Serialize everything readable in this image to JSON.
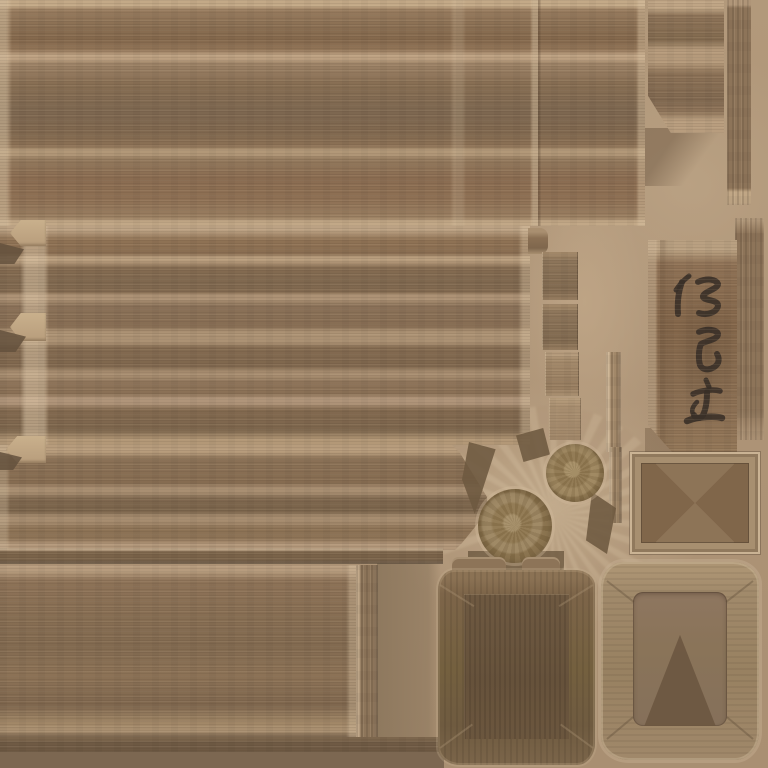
{
  "meta": {
    "title": "wooden-texture-atlas",
    "description": "Game texture atlas of weathered wooden planks, a vertical Japanese shop sign, round log-end discs, a square tub panel and two wooden frames on a tan background",
    "canvas_width": 768,
    "canvas_height": 768
  },
  "palette": {
    "background": "#b2997b",
    "background_dark": "#8a745a",
    "plank": "#8b7257",
    "plank_dark": "#7f684f",
    "seam_light": "#c2aa8b",
    "edge_shadow": "#5f4d3b",
    "sign_board": "#83664a",
    "ink": "#3a3028",
    "panel": "#74603f",
    "frame_wood": "#a18a6b",
    "knob_wood": "#9c8662",
    "wedge": "#6d5940"
  },
  "sign": {
    "text": "仁己堂",
    "characters": [
      "仁",
      "己",
      "堂"
    ],
    "orientation": "vertical",
    "style": "brush calligraphy, carved dark ink on wood board",
    "ink_color": "#3a3028",
    "glyphs": [
      {
        "name": "char-1",
        "strokes": [
          {
            "d": "M21,10 C17,13 12,18 8,24",
            "w": 5
          },
          {
            "d": "M14,16 C11,24 9,34 10,48",
            "w": 6
          },
          {
            "d": "M30,16 C39,12 48,13 50,18 C50,23 37,25 35,30 C34,35 49,33 50,39 C50,46 39,50 31,47",
            "w": 6
          }
        ]
      },
      {
        "name": "char-2",
        "strokes": [
          {
            "d": "M31,66 C40,62 49,64 50,68 C50,74 37,75 33,78 C31,82 30,92 32,99 C35,106 46,104 50,97 C51,94 51,91 49,88",
            "w": 6
          }
        ]
      },
      {
        "name": "char-3",
        "strokes": [
          {
            "d": "M38,114 L41,121",
            "w": 5
          },
          {
            "d": "M25,128 C33,124 46,123 52,125",
            "w": 5.5
          },
          {
            "d": "M39,126 C39,136 38,143 35,149 C33,153 28,153 26,149",
            "w": 6
          },
          {
            "d": "M29,136 C25,140 23,144 25,148",
            "w": 4.5
          },
          {
            "d": "M19,155 C31,150 48,150 54,152",
            "w": 6.5
          }
        ]
      }
    ]
  },
  "regions": [
    {
      "name": "plank-sheet-top",
      "description": "wide horizontal plank sheet, top of atlas"
    },
    {
      "name": "plank-piece-top-right",
      "description": "short plank piece with diagonal cut corner"
    },
    {
      "name": "vertical-strip-top-right",
      "description": "narrow vertical-grain strip at right edge"
    },
    {
      "name": "shop-sign-board",
      "description": "vertical wooden sign with three calligraphy characters"
    },
    {
      "name": "plank-sheet-middle",
      "description": "plank sheet with mortise tabs on left edge"
    },
    {
      "name": "plank-band-lower",
      "description": "plank band ending in pointed wedge"
    },
    {
      "name": "log-end-discs",
      "description": "two round sawn log-end discs with growth rings"
    },
    {
      "name": "small-picture-frame",
      "description": "thin rectangular wooden frame with mitred corners"
    },
    {
      "name": "square-tub-panel",
      "description": "dark square panel with wavy edges and inset box interior"
    },
    {
      "name": "large-wavy-frame",
      "description": "thick organic-edged wooden frame with shadow triangle inside"
    },
    {
      "name": "bottom-left-planks",
      "description": "plank block, thin strips and vertical batten at bottom left"
    }
  ]
}
